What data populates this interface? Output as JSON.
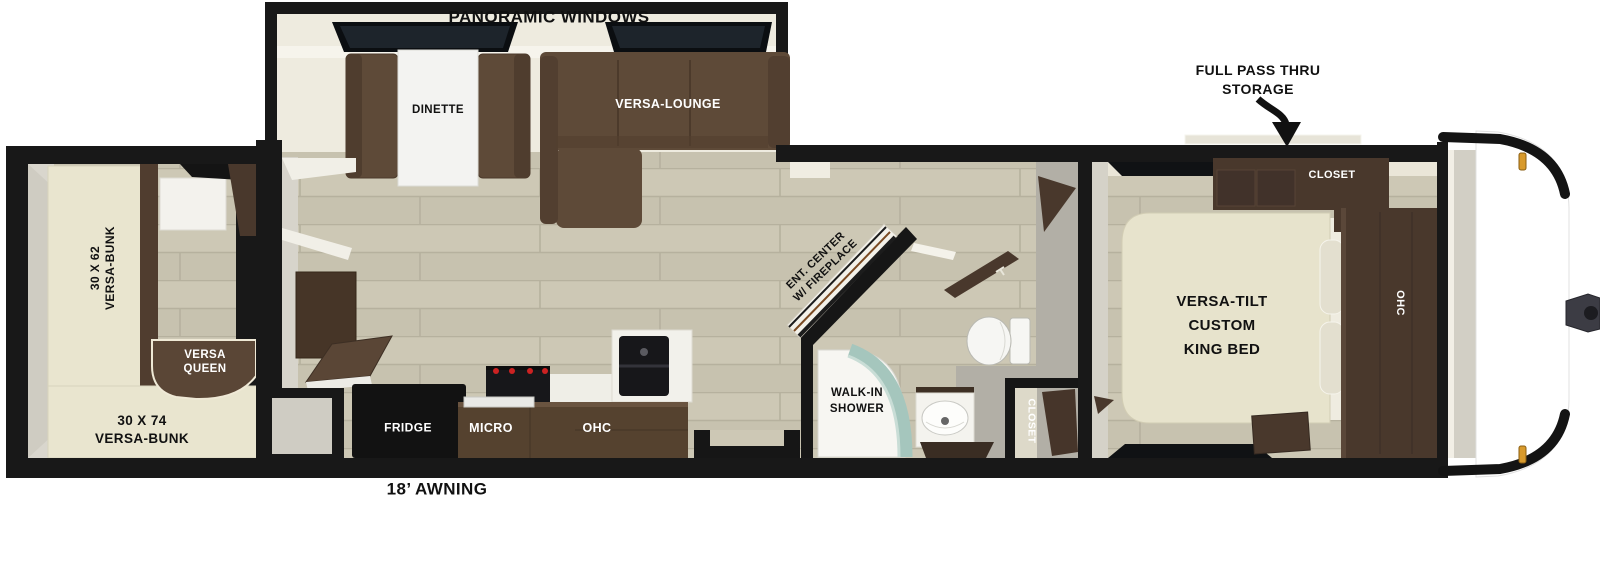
{
  "title": "Travel trailer floor plan",
  "labels": {
    "panoramic_windows": "PANORAMIC WINDOWS",
    "dinette": "DINETTE",
    "versa_lounge": "VERSA-LOUNGE",
    "pass_thru_line1": "FULL PASS THRU",
    "pass_thru_line2": "STORAGE",
    "closet_bedroom": "CLOSET",
    "ohc_bedroom": "OHC",
    "king_bed_line1": "VERSA-TILT",
    "king_bed_line2": "CUSTOM",
    "king_bed_line3": "KING BED",
    "bunk_left_line1": "30 X 62",
    "bunk_left_line2": "VERSA-BUNK",
    "versa_queen_line1": "VERSA",
    "versa_queen_line2": "QUEEN",
    "bunk_bottom_line1": "30 X 74",
    "bunk_bottom_line2": "VERSA-BUNK",
    "fridge": "FRIDGE",
    "micro": "MICRO",
    "ohc_kitchen": "OHC",
    "ent_center_line1": "ENT. CENTER",
    "ent_center_line2": "W/ FIREPLACE",
    "walk_in_shower_line1": "WALK-IN",
    "walk_in_shower_line2": "SHOWER",
    "closet_bath": "CLOSET",
    "awning": "18’ AWNING"
  },
  "colors": {
    "wall_black": "#181818",
    "floor_plank": "#cdc8b5",
    "plank_line": "#b6b19e",
    "slide_floor": "#eeebdf",
    "sofa_brown": "#5e4a38",
    "cabinet_brown": "#49382c",
    "counter_brown": "#55422f",
    "bed_cream": "#e7e3cc",
    "bunk_cream": "#e9e5cf",
    "wall_gray": "#b2afa6",
    "light_gray": "#d5d2c8",
    "shower_glass": "#a5c6bd",
    "marker_amber": "#d89a2c",
    "hitch_gray": "#3c3c44"
  }
}
